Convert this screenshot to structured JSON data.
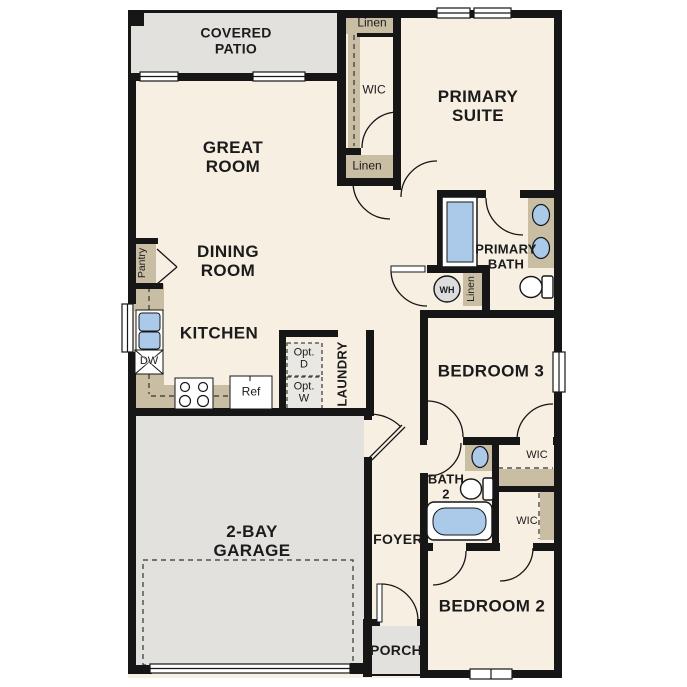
{
  "plan_title": "Single-story 3-bedroom floor plan",
  "colors": {
    "wall": "#161616",
    "floor": "#f7efe2",
    "concrete": "#e2e1dd",
    "cabinetry": "#c9bda4",
    "fixture_blue": "#abc9e9"
  },
  "rooms": {
    "covered_patio": {
      "line1": "COVERED",
      "line2": "PATIO"
    },
    "great_room": {
      "line1": "GREAT",
      "line2": "ROOM"
    },
    "dining_room": {
      "line1": "DINING",
      "line2": "ROOM"
    },
    "kitchen": {
      "label": "KITCHEN"
    },
    "garage": {
      "line1": "2-BAY",
      "line2": "GARAGE"
    },
    "primary_suite": {
      "line1": "PRIMARY",
      "line2": "SUITE"
    },
    "primary_bath": {
      "line1": "PRIMARY",
      "line2": "BATH"
    },
    "bedroom3": {
      "label": "BEDROOM 3"
    },
    "bedroom2": {
      "label": "BEDROOM 2"
    },
    "bath2": {
      "line1": "BATH",
      "line2": "2"
    },
    "foyer": {
      "label": "FOYER"
    },
    "porch": {
      "label": "PORCH"
    },
    "laundry": {
      "label": "LAUNDRY"
    }
  },
  "closets": {
    "wic_primary": "WIC",
    "wic_bedroom3": "WIC",
    "wic_bedroom2": "WIC",
    "linen_hall_top": "Linen",
    "linen_hall": "Linen",
    "linen_utility": "Linen",
    "pantry": "Pantry"
  },
  "appliances": {
    "water_heater": "WH",
    "dishwasher": "DW",
    "refrigerator": "Ref",
    "optional_dryer": {
      "line1": "Opt.",
      "line2": "D"
    },
    "optional_washer": {
      "line1": "Opt.",
      "line2": "W"
    }
  },
  "fixtures": [
    "shower",
    "double-vanity-sinks",
    "toilet",
    "bathtub",
    "kitchen-sink",
    "stove-burners",
    "bathroom-sink",
    "garage-door",
    "window",
    "door-swing"
  ]
}
